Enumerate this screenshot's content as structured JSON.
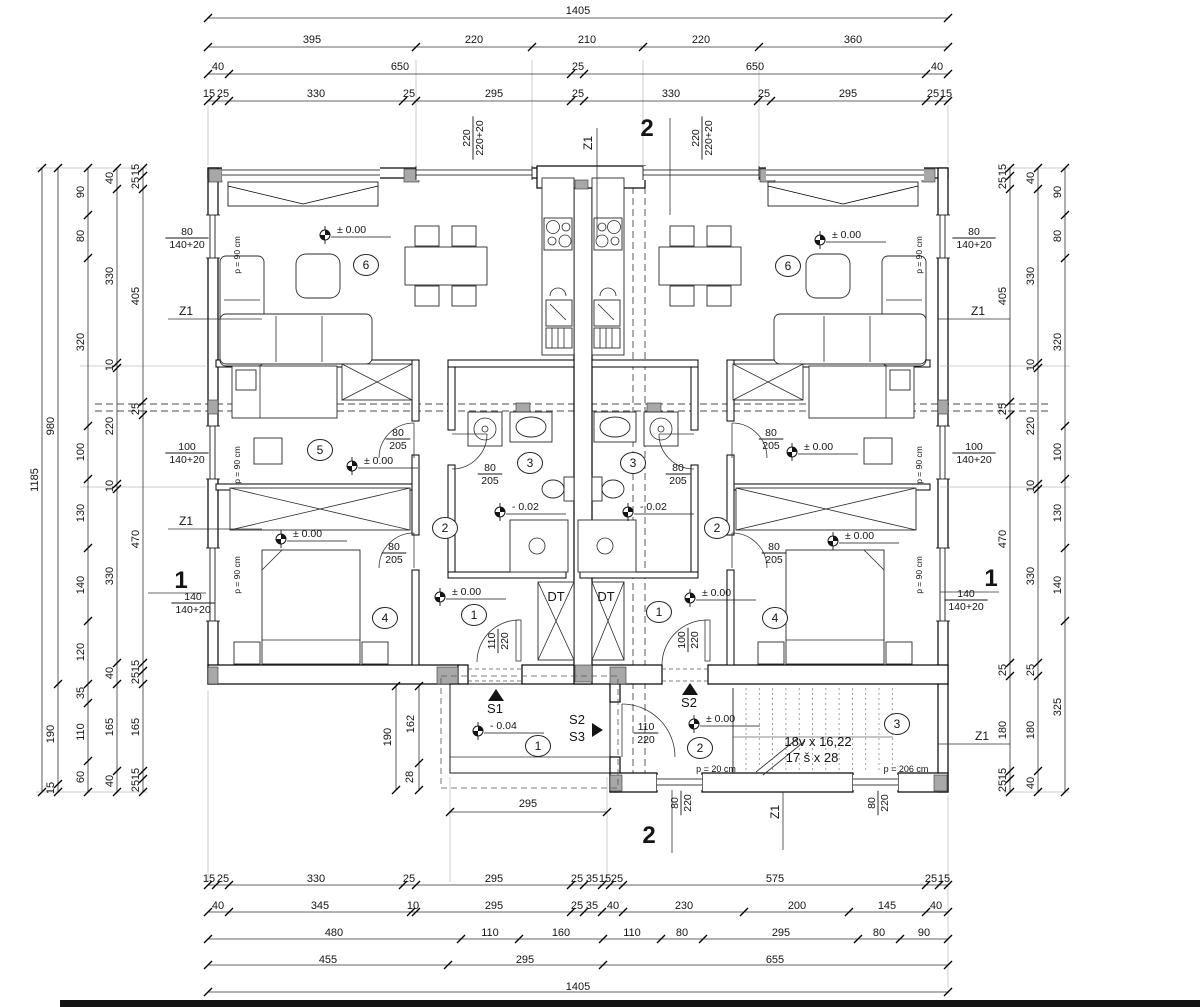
{
  "sheet": {
    "background": "#ffffff",
    "edge_bar_color": "#141414"
  },
  "dim_texts": [
    [
      "1405",
      578,
      14
    ],
    [
      "395",
      312,
      43
    ],
    [
      "220",
      474,
      43
    ],
    [
      "210",
      587,
      43
    ],
    [
      "220",
      701,
      43
    ],
    [
      "360",
      853,
      43
    ],
    [
      "40",
      218,
      70
    ],
    [
      "650",
      400,
      70
    ],
    [
      "25",
      578,
      70
    ],
    [
      "650",
      755,
      70
    ],
    [
      "40",
      937,
      70
    ],
    [
      "15",
      209,
      97
    ],
    [
      "25",
      223,
      97
    ],
    [
      "330",
      316,
      97
    ],
    [
      "25",
      409,
      97
    ],
    [
      "295",
      494,
      97
    ],
    [
      "25",
      578,
      97
    ],
    [
      "330",
      671,
      97
    ],
    [
      "25",
      764,
      97
    ],
    [
      "295",
      848,
      97
    ],
    [
      "25",
      933,
      97
    ],
    [
      "15",
      946,
      97
    ],
    [
      "15",
      209,
      882
    ],
    [
      "25",
      223,
      882
    ],
    [
      "330",
      316,
      882
    ],
    [
      "25",
      409,
      882
    ],
    [
      "295",
      494,
      882
    ],
    [
      "25",
      577,
      882
    ],
    [
      "35",
      592,
      882
    ],
    [
      "15",
      605,
      882
    ],
    [
      "25",
      617,
      882
    ],
    [
      "575",
      775,
      882
    ],
    [
      "25",
      931,
      882
    ],
    [
      "15",
      944,
      882
    ],
    [
      "40",
      218,
      909
    ],
    [
      "345",
      320,
      909
    ],
    [
      "10",
      413,
      909
    ],
    [
      "295",
      494,
      909
    ],
    [
      "25",
      577,
      909
    ],
    [
      "35",
      592,
      909
    ],
    [
      "40",
      613,
      909
    ],
    [
      "230",
      684,
      909
    ],
    [
      "200",
      797,
      909
    ],
    [
      "145",
      887,
      909
    ],
    [
      "40",
      936,
      909
    ],
    [
      "480",
      334,
      936
    ],
    [
      "110",
      490,
      936
    ],
    [
      "160",
      561,
      936
    ],
    [
      "110",
      632,
      936
    ],
    [
      "80",
      682,
      936
    ],
    [
      "295",
      781,
      936
    ],
    [
      "80",
      879,
      936
    ],
    [
      "90",
      924,
      936
    ],
    [
      "455",
      328,
      963
    ],
    [
      "295",
      525,
      963
    ],
    [
      "655",
      775,
      963
    ],
    [
      "1405",
      578,
      990
    ],
    [
      "1185",
      38,
      480,
      -90
    ],
    [
      "980",
      54,
      426,
      -90
    ],
    [
      "190",
      54,
      734,
      -90
    ],
    [
      "15",
      54,
      788,
      -90
    ],
    [
      "90",
      84,
      192,
      -90
    ],
    [
      "80",
      84,
      236,
      -90
    ],
    [
      "320",
      84,
      342,
      -90
    ],
    [
      "100",
      84,
      452,
      -90
    ],
    [
      "130",
      84,
      513,
      -90
    ],
    [
      "140",
      84,
      585,
      -90
    ],
    [
      "120",
      84,
      652,
      -90
    ],
    [
      "35",
      84,
      693,
      -90
    ],
    [
      "110",
      84,
      732,
      -90
    ],
    [
      "60",
      84,
      777,
      -90
    ],
    [
      "40",
      113,
      178,
      -90
    ],
    [
      "330",
      113,
      276,
      -90
    ],
    [
      "10",
      113,
      365,
      -90
    ],
    [
      "220",
      113,
      426,
      -90
    ],
    [
      "10",
      113,
      486,
      -90
    ],
    [
      "330",
      113,
      576,
      -90
    ],
    [
      "40",
      113,
      673,
      -90
    ],
    [
      "165",
      113,
      727,
      -90
    ],
    [
      "40",
      113,
      781,
      -90
    ],
    [
      "15",
      139,
      170,
      -90
    ],
    [
      "25",
      139,
      183,
      -90
    ],
    [
      "405",
      139,
      296,
      -90
    ],
    [
      "25",
      139,
      409,
      -90
    ],
    [
      "470",
      139,
      539,
      -90
    ],
    [
      "15",
      139,
      666,
      -90
    ],
    [
      "25",
      139,
      678,
      -90
    ],
    [
      "165",
      139,
      727,
      -90
    ],
    [
      "15",
      139,
      774,
      -90
    ],
    [
      "25",
      139,
      786,
      -90
    ],
    [
      "15",
      1006,
      170,
      -90
    ],
    [
      "25",
      1006,
      183,
      -90
    ],
    [
      "405",
      1006,
      296,
      -90
    ],
    [
      "25",
      1006,
      409,
      -90
    ],
    [
      "470",
      1006,
      539,
      -90
    ],
    [
      "25",
      1006,
      670,
      -90
    ],
    [
      "180",
      1006,
      730,
      -90
    ],
    [
      "15",
      1006,
      774,
      -90
    ],
    [
      "25",
      1006,
      786,
      -90
    ],
    [
      "40",
      1034,
      178,
      -90
    ],
    [
      "330",
      1034,
      276,
      -90
    ],
    [
      "10",
      1034,
      365,
      -90
    ],
    [
      "220",
      1034,
      426,
      -90
    ],
    [
      "10",
      1034,
      486,
      -90
    ],
    [
      "330",
      1034,
      576,
      -90
    ],
    [
      "25",
      1034,
      670,
      -90
    ],
    [
      "180",
      1034,
      730,
      -90
    ],
    [
      "40",
      1034,
      783,
      -90
    ],
    [
      "90",
      1061,
      192,
      -90
    ],
    [
      "80",
      1061,
      236,
      -90
    ],
    [
      "320",
      1061,
      342,
      -90
    ],
    [
      "100",
      1061,
      452,
      -90
    ],
    [
      "130",
      1061,
      513,
      -90
    ],
    [
      "140",
      1061,
      585,
      -90
    ],
    [
      "325",
      1061,
      707,
      -90
    ],
    [
      "190",
      391,
      737,
      -90
    ],
    [
      "162",
      414,
      724,
      -90
    ],
    [
      "28",
      413,
      777,
      -90
    ],
    [
      "295",
      528,
      807
    ]
  ],
  "annotation_texts": [
    [
      "Z1",
      186,
      315,
      0,
      12
    ],
    [
      "Z1",
      186,
      525,
      0,
      12
    ],
    [
      "Z1",
      978,
      315,
      0,
      12
    ],
    [
      "Z1",
      982,
      740,
      0,
      12
    ],
    [
      "Z1",
      592,
      143,
      -90,
      12
    ],
    [
      "Z1",
      779,
      812,
      -90,
      12
    ],
    [
      "DT",
      556,
      601,
      0,
      13
    ],
    [
      "DT",
      606,
      601,
      0,
      13
    ],
    [
      "18v x 16,22",
      818,
      746,
      0,
      13
    ],
    [
      "17 š x 28",
      812,
      762,
      0,
      13
    ],
    [
      "p = 20 cm",
      716,
      772,
      0,
      9
    ],
    [
      "p = 206 cm",
      906,
      772,
      0,
      9
    ],
    [
      "S1",
      495,
      713,
      0,
      13
    ],
    [
      "S2",
      577,
      724,
      0,
      13
    ],
    [
      "S3",
      577,
      741,
      0,
      13
    ],
    [
      "S2",
      689,
      707,
      0,
      13
    ],
    [
      "p = 90 cm",
      240,
      255,
      -90,
      8.5
    ],
    [
      "p = 90 cm",
      240,
      465,
      -90,
      8.5
    ],
    [
      "p = 90 cm",
      240,
      575,
      -90,
      8.5
    ],
    [
      "p = 90 cm",
      922,
      255,
      -90,
      8.5
    ],
    [
      "p = 90 cm",
      922,
      465,
      -90,
      8.5
    ],
    [
      "p = 90 cm",
      922,
      575,
      -90,
      8.5
    ],
    [
      "2",
      647,
      136,
      0,
      24,
      1
    ],
    [
      "2",
      649,
      843,
      0,
      24,
      1
    ],
    [
      "1",
      181,
      588,
      0,
      24,
      1
    ],
    [
      "1",
      991,
      586,
      0,
      24,
      1
    ]
  ],
  "frac_labels": [
    [
      "80",
      "140+20",
      187,
      238,
      0
    ],
    [
      "100",
      "140+20",
      187,
      453,
      0
    ],
    [
      "140",
      "140+20",
      193,
      603,
      0
    ],
    [
      "80",
      "140+20",
      974,
      238,
      0
    ],
    [
      "100",
      "140+20",
      974,
      453,
      0
    ],
    [
      "140",
      "140+20",
      966,
      600,
      0
    ],
    [
      "220",
      "220+20",
      473,
      138,
      -90
    ],
    [
      "220",
      "220+20",
      702,
      138,
      -90
    ],
    [
      "80",
      "205",
      398,
      439,
      0
    ],
    [
      "80",
      "205",
      394,
      553,
      0
    ],
    [
      "80",
      "205",
      490,
      474,
      0
    ],
    [
      "80",
      "205",
      771,
      439,
      0
    ],
    [
      "80",
      "205",
      774,
      553,
      0
    ],
    [
      "80",
      "205",
      678,
      474,
      0
    ],
    [
      "110",
      "220",
      498,
      641,
      -90
    ],
    [
      "100",
      "220",
      688,
      640,
      -90
    ],
    [
      "110",
      "220",
      646,
      733,
      0
    ],
    [
      "80",
      "220",
      681,
      803,
      -90
    ],
    [
      "80",
      "220",
      878,
      803,
      -90
    ]
  ],
  "level_markers": [
    [
      "± 0.00",
      325,
      235
    ],
    [
      "± 0.00",
      820,
      240
    ],
    [
      "± 0.00",
      352,
      466
    ],
    [
      "± 0.00",
      792,
      452
    ],
    [
      "± 0.00",
      281,
      539
    ],
    [
      "± 0.00",
      833,
      541
    ],
    [
      "± 0.00",
      440,
      597
    ],
    [
      "± 0.00",
      690,
      598
    ],
    [
      "- 0.02",
      500,
      512
    ],
    [
      "- 0.02",
      628,
      512
    ],
    [
      "- 0.04",
      478,
      731
    ],
    [
      "± 0.00",
      694,
      724
    ]
  ],
  "room_markers": [
    [
      "6",
      366,
      265
    ],
    [
      "6",
      788,
      266
    ],
    [
      "5",
      320,
      450
    ],
    [
      "2",
      445,
      528
    ],
    [
      "2",
      717,
      528
    ],
    [
      "3",
      530,
      463
    ],
    [
      "3",
      633,
      463
    ],
    [
      "4",
      385,
      618
    ],
    [
      "4",
      775,
      618
    ],
    [
      "1",
      474,
      615
    ],
    [
      "1",
      659,
      612
    ],
    [
      "1",
      538,
      746
    ],
    [
      "2",
      700,
      748
    ],
    [
      "3",
      897,
      724
    ]
  ],
  "direction_arrows": [
    [
      "up",
      496,
      695
    ],
    [
      "up",
      690,
      689
    ],
    [
      "right",
      592,
      730
    ]
  ],
  "dim_lines": [
    [
      208,
      18,
      948,
      18
    ],
    [
      208,
      47,
      948,
      47
    ],
    [
      208,
      74,
      948,
      74
    ],
    [
      208,
      101,
      948,
      101
    ],
    [
      208,
      885,
      948,
      885
    ],
    [
      208,
      912,
      948,
      912
    ],
    [
      208,
      939,
      948,
      939
    ],
    [
      208,
      965,
      948,
      965
    ],
    [
      208,
      992,
      948,
      992
    ],
    [
      42,
      168,
      42,
      792
    ],
    [
      58,
      168,
      58,
      792
    ],
    [
      88,
      168,
      88,
      792
    ],
    [
      117,
      168,
      117,
      792
    ],
    [
      143,
      168,
      143,
      792
    ],
    [
      1010,
      168,
      1010,
      792
    ],
    [
      1038,
      168,
      1038,
      792
    ],
    [
      1065,
      168,
      1065,
      792
    ],
    [
      450,
      812,
      607,
      812
    ],
    [
      396,
      686,
      396,
      790
    ],
    [
      419,
      686,
      419,
      790
    ],
    [
      670,
      118,
      670,
      215
    ],
    [
      672,
      790,
      672,
      853
    ],
    [
      148,
      593,
      206,
      593
    ],
    [
      940,
      592,
      999,
      592
    ],
    [
      168,
      319,
      262,
      319
    ],
    [
      168,
      529,
      262,
      529
    ],
    [
      938,
      319,
      1010,
      319
    ],
    [
      938,
      744,
      1010,
      744
    ],
    [
      597,
      128,
      597,
      238
    ],
    [
      783,
      792,
      783,
      850
    ]
  ],
  "ext_lines": [
    [
      36,
      168,
      148,
      168
    ],
    [
      36,
      792,
      148,
      792
    ],
    [
      1004,
      168,
      1070,
      168
    ],
    [
      1004,
      792,
      1070,
      792
    ],
    [
      416,
      60,
      416,
      166
    ],
    [
      532,
      60,
      532,
      166
    ],
    [
      643,
      60,
      643,
      166
    ],
    [
      759,
      60,
      759,
      166
    ],
    [
      208,
      105,
      208,
      165
    ],
    [
      948,
      105,
      948,
      165
    ],
    [
      450,
      777,
      450,
      882
    ],
    [
      607,
      777,
      607,
      882
    ],
    [
      208,
      690,
      208,
      882
    ],
    [
      948,
      795,
      948,
      988
    ],
    [
      80,
      366,
      206,
      366
    ],
    [
      80,
      487,
      206,
      487
    ],
    [
      940,
      366,
      1070,
      366
    ],
    [
      940,
      487,
      1070,
      487
    ]
  ],
  "ticks": [
    [
      208,
      18
    ],
    [
      948,
      18
    ],
    [
      208,
      47
    ],
    [
      416,
      47
    ],
    [
      532,
      47
    ],
    [
      643,
      47
    ],
    [
      759,
      47
    ],
    [
      948,
      47
    ],
    [
      208,
      74
    ],
    [
      229,
      74
    ],
    [
      571,
      74
    ],
    [
      584,
      74
    ],
    [
      926,
      74
    ],
    [
      948,
      74
    ],
    [
      208,
      101
    ],
    [
      216,
      101
    ],
    [
      229,
      101
    ],
    [
      403,
      101
    ],
    [
      416,
      101
    ],
    [
      571,
      101
    ],
    [
      584,
      101
    ],
    [
      758,
      101
    ],
    [
      771,
      101
    ],
    [
      926,
      101
    ],
    [
      939,
      101
    ],
    [
      948,
      101
    ],
    [
      208,
      885
    ],
    [
      216,
      885
    ],
    [
      229,
      885
    ],
    [
      403,
      885
    ],
    [
      416,
      885
    ],
    [
      571,
      885
    ],
    [
      584,
      885
    ],
    [
      602,
      885
    ],
    [
      610,
      885
    ],
    [
      623,
      885
    ],
    [
      926,
      885
    ],
    [
      939,
      885
    ],
    [
      948,
      885
    ],
    [
      208,
      912
    ],
    [
      229,
      912
    ],
    [
      411,
      912
    ],
    [
      416,
      912
    ],
    [
      571,
      912
    ],
    [
      584,
      912
    ],
    [
      602,
      912
    ],
    [
      623,
      912
    ],
    [
      744,
      912
    ],
    [
      849,
      912
    ],
    [
      926,
      912
    ],
    [
      948,
      912
    ],
    [
      208,
      939
    ],
    [
      461,
      939
    ],
    [
      519,
      939
    ],
    [
      603,
      939
    ],
    [
      661,
      939
    ],
    [
      703,
      939
    ],
    [
      858,
      939
    ],
    [
      900,
      939
    ],
    [
      948,
      939
    ],
    [
      208,
      965
    ],
    [
      448,
      965
    ],
    [
      603,
      965
    ],
    [
      948,
      965
    ],
    [
      208,
      992
    ],
    [
      948,
      992
    ],
    [
      42,
      168
    ],
    [
      42,
      792
    ],
    [
      58,
      168
    ],
    [
      58,
      684
    ],
    [
      58,
      784
    ],
    [
      58,
      792
    ],
    [
      88,
      168
    ],
    [
      88,
      215
    ],
    [
      88,
      258
    ],
    [
      88,
      426
    ],
    [
      88,
      479
    ],
    [
      88,
      548
    ],
    [
      88,
      621
    ],
    [
      88,
      684
    ],
    [
      88,
      703
    ],
    [
      88,
      761
    ],
    [
      88,
      792
    ],
    [
      117,
      168
    ],
    [
      117,
      189
    ],
    [
      117,
      363
    ],
    [
      117,
      368
    ],
    [
      117,
      484
    ],
    [
      117,
      489
    ],
    [
      117,
      663
    ],
    [
      117,
      684
    ],
    [
      117,
      771
    ],
    [
      117,
      792
    ],
    [
      143,
      168
    ],
    [
      143,
      176
    ],
    [
      143,
      189
    ],
    [
      143,
      402
    ],
    [
      143,
      415
    ],
    [
      143,
      663
    ],
    [
      143,
      671
    ],
    [
      143,
      684
    ],
    [
      143,
      771
    ],
    [
      143,
      779
    ],
    [
      143,
      792
    ],
    [
      1010,
      168
    ],
    [
      1010,
      176
    ],
    [
      1010,
      189
    ],
    [
      1010,
      402
    ],
    [
      1010,
      415
    ],
    [
      1010,
      663
    ],
    [
      1010,
      676
    ],
    [
      1010,
      771
    ],
    [
      1010,
      779
    ],
    [
      1010,
      792
    ],
    [
      1038,
      168
    ],
    [
      1038,
      189
    ],
    [
      1038,
      363
    ],
    [
      1038,
      368
    ],
    [
      1038,
      484
    ],
    [
      1038,
      489
    ],
    [
      1038,
      663
    ],
    [
      1038,
      676
    ],
    [
      1038,
      771
    ],
    [
      1038,
      792
    ],
    [
      1065,
      168
    ],
    [
      1065,
      215
    ],
    [
      1065,
      258
    ],
    [
      1065,
      426
    ],
    [
      1065,
      479
    ],
    [
      1065,
      548
    ],
    [
      1065,
      621
    ],
    [
      1065,
      792
    ],
    [
      450,
      812
    ],
    [
      607,
      812
    ],
    [
      396,
      686
    ],
    [
      396,
      790
    ],
    [
      419,
      686
    ],
    [
      419,
      763
    ],
    [
      419,
      790
    ]
  ]
}
